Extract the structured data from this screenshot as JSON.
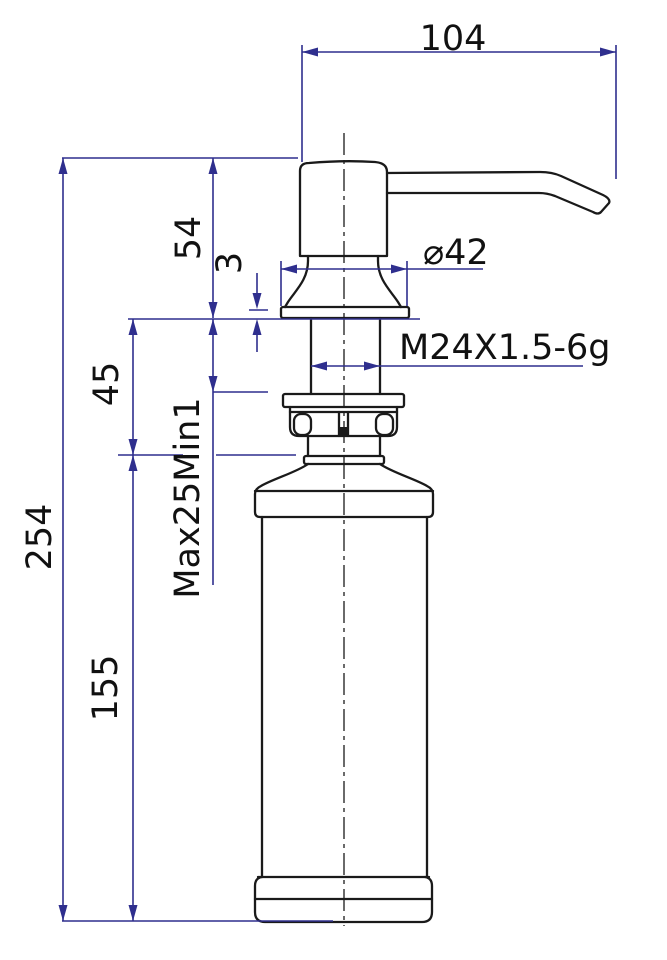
{
  "title": "Soap dispenser technical dimension drawing",
  "colors": {
    "background": "#ffffff",
    "outline": "#1a1a1a",
    "dimension_line": "#2f2f8e",
    "label_text": "#111111"
  },
  "dims": {
    "spout_reach": "104",
    "head_height": "54",
    "flange_thickness": "3",
    "neck_exposed_height": "45",
    "overall_height": "254",
    "bottle_height": "155",
    "mount_thickness_range": "Max25Min1",
    "flange_diameter": "⌀42",
    "thread_spec": "M24X1.5-6g"
  }
}
